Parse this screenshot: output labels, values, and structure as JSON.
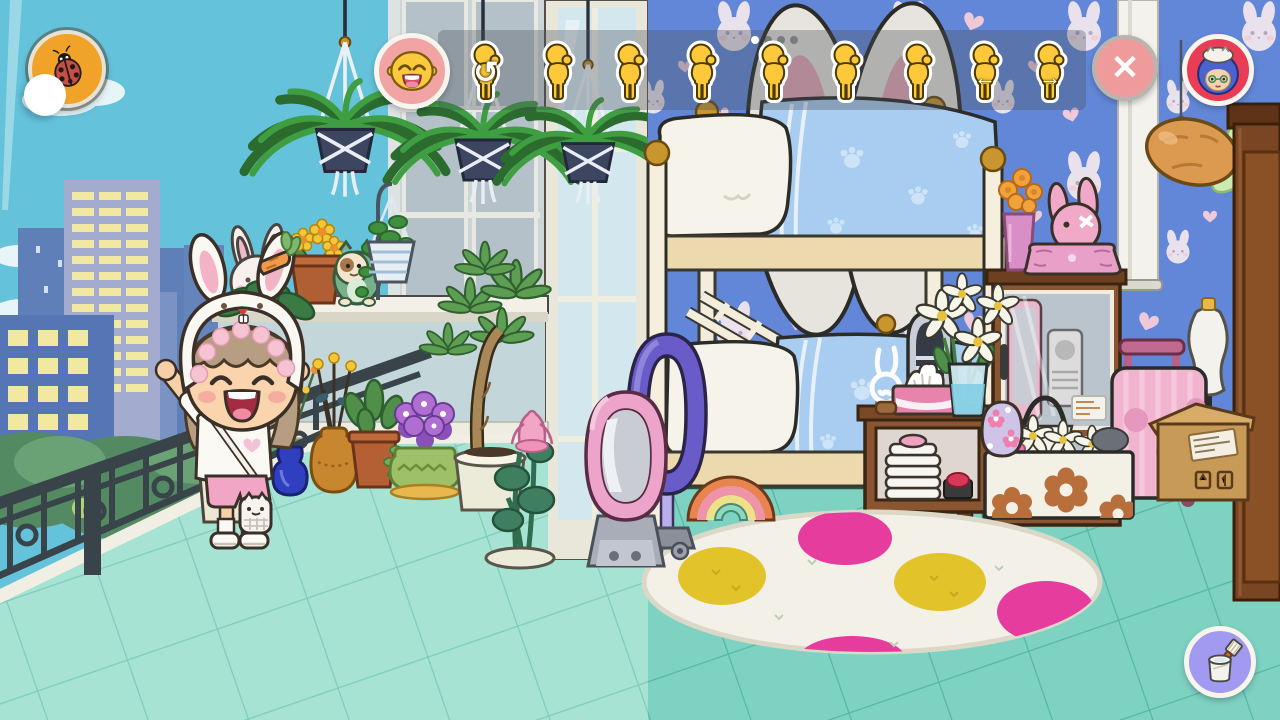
{
  "toolbar": {
    "background_rgba": "rgba(72,78,92,0.34)",
    "emoji_button": {
      "icon": "laughing-emoji-icon",
      "bg": "#f2a3a3"
    },
    "pose_buttons": [
      {
        "icon": "pose-reset-icon",
        "overlay_glyph": "↺"
      },
      {
        "icon": "pose-stand-icon"
      },
      {
        "icon": "pose-stand-icon"
      },
      {
        "icon": "pose-hands-on-hips-icon"
      },
      {
        "icon": "pose-hand-out-icon"
      },
      {
        "icon": "pose-flex-icon"
      },
      {
        "icon": "pose-point-icon"
      },
      {
        "icon": "pose-turn-left-icon",
        "overlay_glyph": "←"
      },
      {
        "icon": "pose-turn-right-icon",
        "overlay_glyph": "→"
      }
    ],
    "page_dots": {
      "count": 4,
      "active_index": 0
    },
    "close_button": {
      "icon": "close-icon",
      "glyph": "✕",
      "bg": "#f09b9b"
    },
    "avatar_button": {
      "icon": "player-avatar-icon",
      "bg": "#e83d55"
    }
  },
  "hud": {
    "pet_button": {
      "icon": "ladybug-icon",
      "bg": "#f0a328"
    },
    "paint_button": {
      "icon": "paint-bucket-icon",
      "bg": "#a29af0"
    }
  },
  "palette": {
    "sky": "#64c2db",
    "wallpaper": "#6387d8",
    "balcony_floor": "#a6e3d3",
    "room_floor": "#7ed2c2",
    "blanket": "#a9cdf0",
    "rug": "#f3f1e7",
    "rug_pink": "#e63c9e",
    "rug_yellow": "#e3c32a"
  }
}
